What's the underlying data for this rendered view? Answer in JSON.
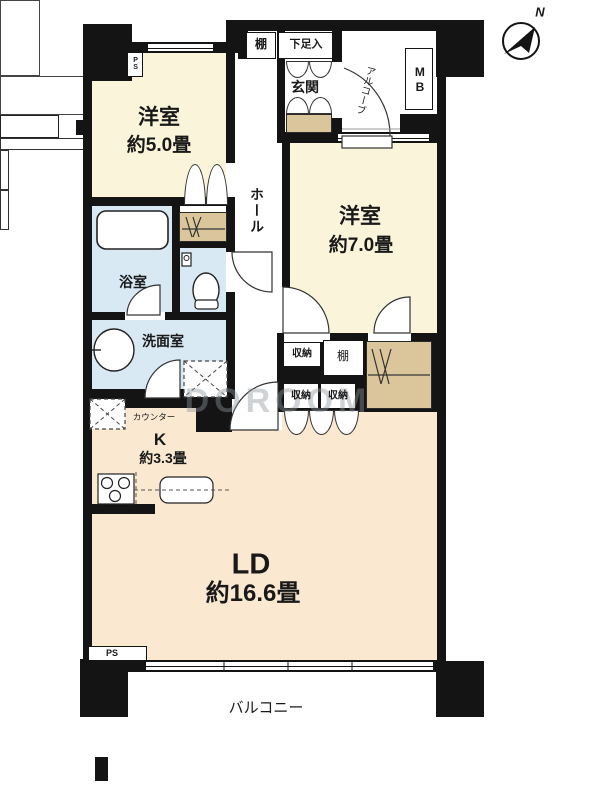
{
  "floorplan": {
    "compass": {
      "north_label": "N"
    },
    "watermark": "DOROOM",
    "rooms": {
      "bedroom_5": {
        "name": "洋室",
        "size": "約5.0畳"
      },
      "bedroom_7": {
        "name": "洋室",
        "size": "約7.0畳"
      },
      "living_dining": {
        "name": "LD",
        "size": "約16.6畳"
      },
      "kitchen": {
        "name": "K",
        "size": "約3.3畳"
      },
      "bathroom": {
        "name": "浴室"
      },
      "washroom": {
        "name": "洗面室"
      },
      "hall": {
        "name": "ホール"
      },
      "entrance": {
        "name": "玄関"
      },
      "alcove": {
        "name": "アルコーブ"
      },
      "balcony": {
        "name": "バルコニー"
      }
    },
    "fixtures": {
      "shelf_top": "棚",
      "shoe_cupboard": "下足入",
      "meter_box": "MB",
      "pipe_space_top": "PS",
      "pipe_space_bottom": "PS",
      "kitchen_counter": "カウンター",
      "shelf_mid": "棚",
      "storage_1": "収納",
      "storage_2": "収納",
      "storage_3": "収納"
    },
    "colors": {
      "wall": "#141414",
      "bedroom_fill": "#faf4da",
      "ldk_fill": "#fae8d0",
      "wet_area_fill": "#d8e9f3",
      "closet_fill": "#dbc69c"
    }
  }
}
